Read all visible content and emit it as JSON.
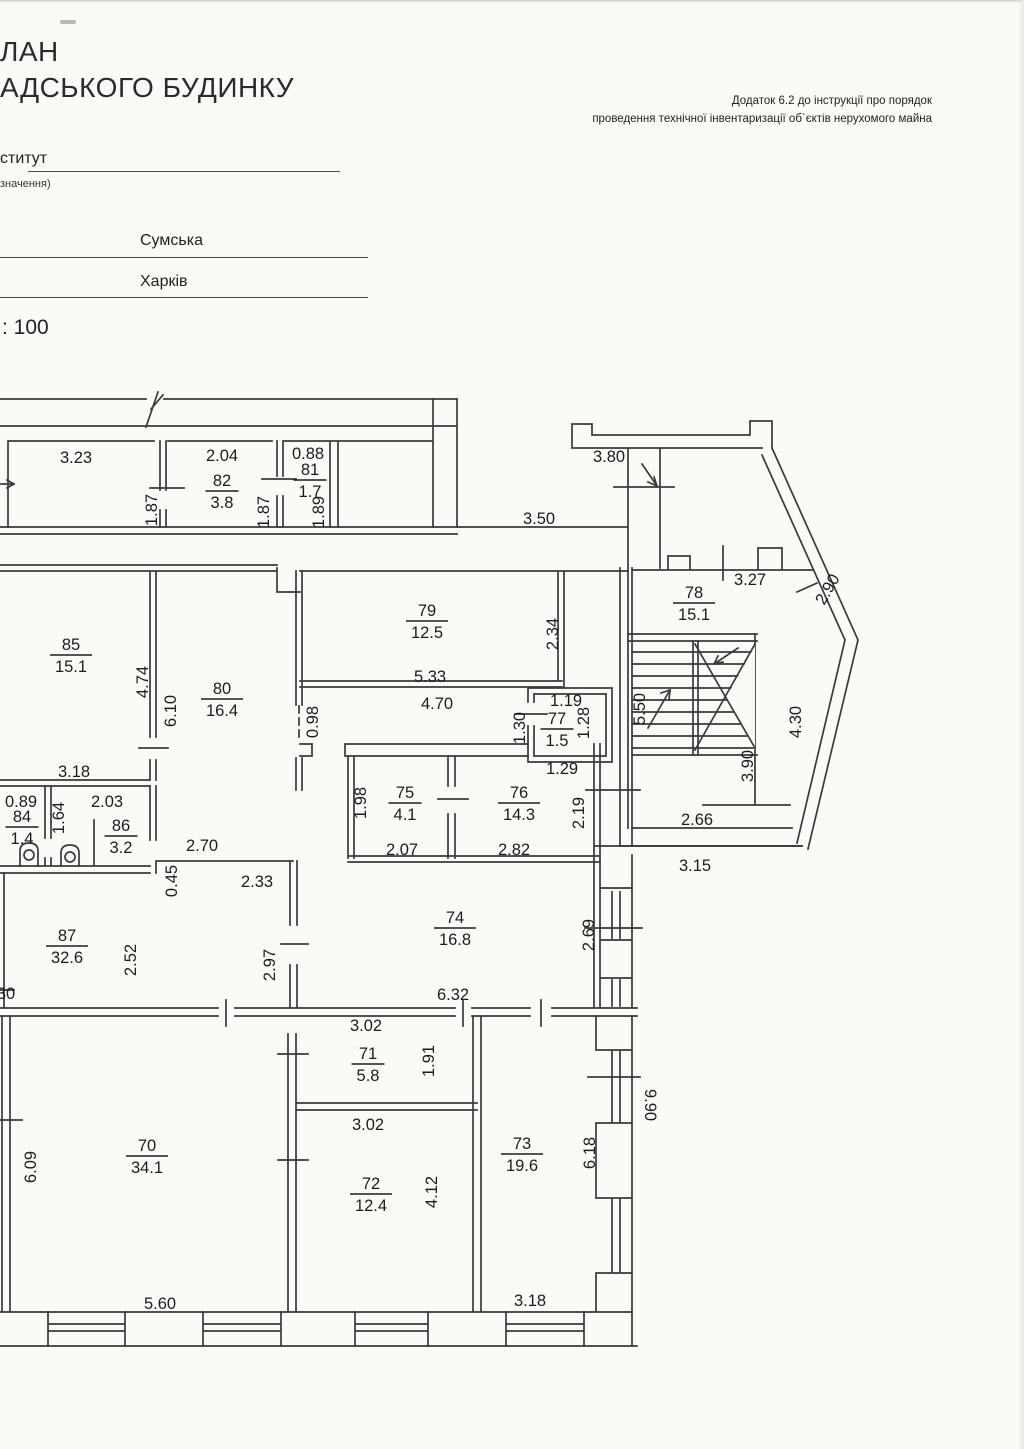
{
  "document": {
    "title_line1": "ЛАН",
    "title_line2": "АДСЬКОГО БУДИНКУ",
    "annotation_line1": "Додаток 6.2 до інструкції про порядок",
    "annotation_line2": "проведення технічної інвентаризації об`єктів нерухомого майна",
    "org_label": "ститут",
    "org_sublabel": "значення)",
    "street": "Сумська",
    "city": "Харків",
    "scale": ": 100"
  },
  "plan": {
    "rooms": [
      {
        "number": "82",
        "area": "3.8",
        "x": 222,
        "y": 491
      },
      {
        "number": "81",
        "area": "1.7",
        "x": 310,
        "y": 480
      },
      {
        "number": "78",
        "area": "15.1",
        "x": 694,
        "y": 603
      },
      {
        "number": "79",
        "area": "12.5",
        "x": 427,
        "y": 621
      },
      {
        "number": "85",
        "area": "15.1",
        "x": 71,
        "y": 655
      },
      {
        "number": "80",
        "area": "16.4",
        "x": 222,
        "y": 699
      },
      {
        "number": "77",
        "area": "1.5",
        "x": 557,
        "y": 729
      },
      {
        "number": "84",
        "area": "1.4",
        "x": 22,
        "y": 827
      },
      {
        "number": "86",
        "area": "3.2",
        "x": 121,
        "y": 836
      },
      {
        "number": "75",
        "area": "4.1",
        "x": 405,
        "y": 803
      },
      {
        "number": "76",
        "area": "14.3",
        "x": 519,
        "y": 803
      },
      {
        "number": "87",
        "area": "32.6",
        "x": 67,
        "y": 946
      },
      {
        "number": "74",
        "area": "16.8",
        "x": 455,
        "y": 928
      },
      {
        "number": "71",
        "area": "5.8",
        "x": 368,
        "y": 1064
      },
      {
        "number": "70",
        "area": "34.1",
        "x": 147,
        "y": 1156
      },
      {
        "number": "72",
        "area": "12.4",
        "x": 371,
        "y": 1194
      },
      {
        "number": "73",
        "area": "19.6",
        "x": 522,
        "y": 1154
      }
    ],
    "dimensions": [
      {
        "text": "3.23",
        "x": 76,
        "y": 457
      },
      {
        "text": "1.87",
        "x": 151,
        "y": 510,
        "rotate": -90
      },
      {
        "text": "2.04",
        "x": 222,
        "y": 455
      },
      {
        "text": "1.87",
        "x": 263,
        "y": 512,
        "rotate": -90
      },
      {
        "text": "0.88",
        "x": 308,
        "y": 453
      },
      {
        "text": "1.89",
        "x": 318,
        "y": 512,
        "rotate": -90
      },
      {
        "text": "3.80",
        "x": 609,
        "y": 456
      },
      {
        "text": "3.50",
        "x": 539,
        "y": 518
      },
      {
        "text": "3.27",
        "x": 750,
        "y": 579
      },
      {
        "text": "2.90",
        "x": 827,
        "y": 589,
        "rotate": -60
      },
      {
        "text": "5.33",
        "x": 430,
        "y": 676
      },
      {
        "text": "2.34",
        "x": 552,
        "y": 634,
        "rotate": -90
      },
      {
        "text": "4.70",
        "x": 437,
        "y": 703
      },
      {
        "text": "1.19",
        "x": 566,
        "y": 700
      },
      {
        "text": "1.30",
        "x": 519,
        "y": 728,
        "rotate": -90
      },
      {
        "text": "1.28",
        "x": 583,
        "y": 723,
        "rotate": -90
      },
      {
        "text": "1.29",
        "x": 562,
        "y": 768
      },
      {
        "text": "5.50",
        "x": 639,
        "y": 709,
        "rotate": -90
      },
      {
        "text": "3.90",
        "x": 747,
        "y": 766,
        "rotate": -90
      },
      {
        "text": "4.30",
        "x": 795,
        "y": 722,
        "rotate": -90
      },
      {
        "text": "2.66",
        "x": 697,
        "y": 819
      },
      {
        "text": "3.15",
        "x": 695,
        "y": 865
      },
      {
        "text": "2.19",
        "x": 578,
        "y": 813,
        "rotate": -90
      },
      {
        "text": "4.74",
        "x": 142,
        "y": 682,
        "rotate": -90
      },
      {
        "text": "6.10",
        "x": 170,
        "y": 711,
        "rotate": -90
      },
      {
        "text": "3.18",
        "x": 74,
        "y": 771
      },
      {
        "text": "0.98",
        "x": 312,
        "y": 722,
        "rotate": -90
      },
      {
        "text": "0.89",
        "x": 21,
        "y": 801
      },
      {
        "text": "1.64",
        "x": 58,
        "y": 818,
        "rotate": -90
      },
      {
        "text": "2.03",
        "x": 107,
        "y": 801
      },
      {
        "text": "2.70",
        "x": 202,
        "y": 845
      },
      {
        "text": "0.45",
        "x": 171,
        "y": 881,
        "rotate": -90
      },
      {
        "text": "2.33",
        "x": 257,
        "y": 881
      },
      {
        "text": "1.98",
        "x": 360,
        "y": 803,
        "rotate": -90
      },
      {
        "text": "2.07",
        "x": 402,
        "y": 849
      },
      {
        "text": "2.82",
        "x": 514,
        "y": 849
      },
      {
        "text": "2.52",
        "x": 130,
        "y": 960,
        "rotate": -90
      },
      {
        "text": "2.97",
        "x": 269,
        "y": 965,
        "rotate": -90
      },
      {
        "text": "30",
        "x": 6,
        "y": 993
      },
      {
        "text": "6.32",
        "x": 453,
        "y": 994
      },
      {
        "text": "2.69",
        "x": 588,
        "y": 935,
        "rotate": -90
      },
      {
        "text": "3.02",
        "x": 366,
        "y": 1025
      },
      {
        "text": "1.91",
        "x": 428,
        "y": 1061,
        "rotate": -90
      },
      {
        "text": "3.02",
        "x": 368,
        "y": 1124
      },
      {
        "text": "6.09",
        "x": 30,
        "y": 1167,
        "rotate": -90
      },
      {
        "text": "4.12",
        "x": 431,
        "y": 1192,
        "rotate": -90
      },
      {
        "text": "6.18",
        "x": 589,
        "y": 1153,
        "rotate": -90
      },
      {
        "text": "9.90",
        "x": 651,
        "y": 1105,
        "rotate": 90
      },
      {
        "text": "5.60",
        "x": 160,
        "y": 1303
      },
      {
        "text": "3.18",
        "x": 530,
        "y": 1300
      }
    ]
  }
}
